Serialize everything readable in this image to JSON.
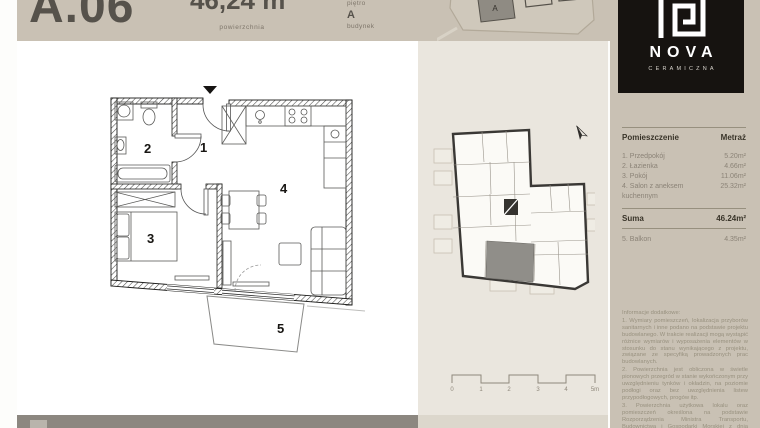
{
  "header": {
    "unit_number": "A.06",
    "area_value": "46,24 m²",
    "area_label": "powierzchnia",
    "floor_label": "piętro",
    "building_value": "A",
    "building_label": "budynek",
    "site_building_label": "A"
  },
  "floor_plan": {
    "rooms": [
      {
        "number": "1",
        "name": "Przedpokój"
      },
      {
        "number": "2",
        "name": "Łazienka"
      },
      {
        "number": "3",
        "name": "Pokój"
      },
      {
        "number": "4",
        "name": "Salon z aneksem kuchennym"
      },
      {
        "number": "5",
        "name": "Balkon"
      }
    ]
  },
  "scale_bar": {
    "labels": [
      "0",
      "1",
      "2",
      "3",
      "4",
      "5m"
    ]
  },
  "sidebar": {
    "logo": {
      "name": "NOVA",
      "subtitle": "CERAMICZNA"
    },
    "table": {
      "col_room": "Pomieszczenie",
      "col_area": "Metraż",
      "rows": [
        {
          "label": "1. Przedpokój",
          "value": "5.20m²"
        },
        {
          "label": "2. Łazienka",
          "value": "4.66m²"
        },
        {
          "label": "3. Pokój",
          "value": "11.06m²"
        },
        {
          "label": "4. Salon z aneksem kuchennym",
          "value": "25.32m²"
        }
      ],
      "sum_label": "Suma",
      "sum_value": "46.24m²",
      "balcony_label": "5. Balkon",
      "balcony_value": "4.35m²"
    },
    "legal": {
      "title": "Informacje dodatkowe:",
      "p1": "1. Wymiary pomieszczeń, lokalizacja przyborów sanitarnych i inne podano na podstawie projektu budowlanego. W trakcie realizacji mogą wystąpić różnice wymiarów i wyposażenia elementów w stosunku do stanu wynikającego z projektu, związane ze specyfiką prowadzonych prac budowlanych.",
      "p2": "2. Powierzchnia jest obliczona w świetle pionowych przegród w stanie wykończonym przy uwzględnieniu tynków i okładzin, na poziomie podłogi oraz bez uwzględnienia listew przypodłogowych, progów itp.",
      "p3": "3. Powierzchnia użytkowa lokalu oraz pomieszczeń określona na podstawie Rozporządzenia Ministra Transportu, Budownictwa i Gospodarki Morskiej z dnia 25.04.2012 w sprawie szczegółowego zakresu i formy projektu budowlanego oraz przy..."
    }
  },
  "colors": {
    "header_beige": "#c9c1b4",
    "light_panel": "#eae6de",
    "footer_gray": "#8c8780",
    "logo_black": "#161310",
    "dark_text": "#56524b",
    "muted_text": "#8b8377",
    "highlight_unit": "#908e89"
  }
}
